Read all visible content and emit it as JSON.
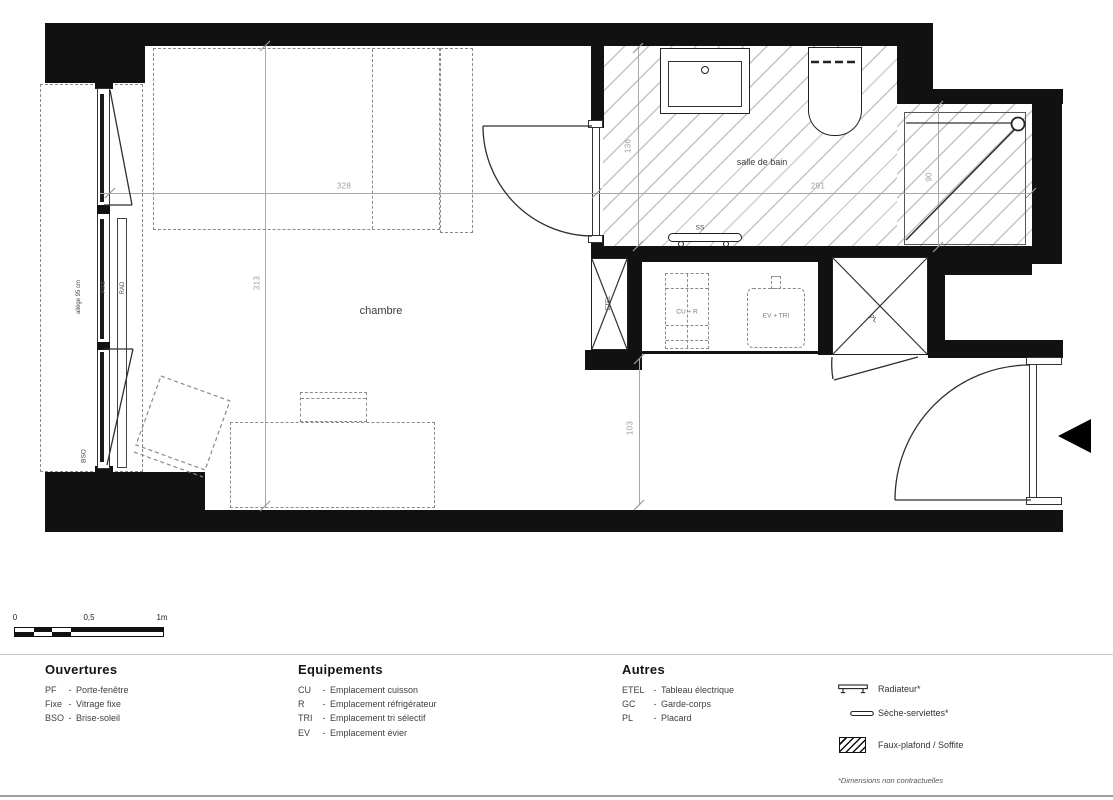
{
  "plan": {
    "rooms": {
      "chambre": "chambre",
      "salle_de_bain": "salle de bain"
    },
    "labels": {
      "ss": "SS",
      "etel": "ETEL",
      "cu_r": "CU + R",
      "ev_tri": "EV + TRI",
      "pl": "PL",
      "fixe": "FIXE",
      "rad": "RAD",
      "bso": "BSO",
      "allege": "allège 95 cm"
    },
    "dims": {
      "chambre_width": "328",
      "chambre_depth": "313",
      "sdb_width": "291",
      "sdb_depth": "136",
      "douche_width": "90",
      "entree_width": "103"
    }
  },
  "scalebar": {
    "tick_0": "0",
    "tick_05": "0,5",
    "tick_1": "1m"
  },
  "legend": {
    "sep": "-",
    "ouvertures": {
      "title": "Ouvertures",
      "items": [
        {
          "abbr": "PF",
          "label": "Porte-fenêtre"
        },
        {
          "abbr": "Fixe",
          "label": "Vitrage fixe"
        },
        {
          "abbr": "BSO",
          "label": "Brise-soleil"
        }
      ]
    },
    "equipements": {
      "title": "Equipements",
      "items": [
        {
          "abbr": "CU",
          "label": "Emplacement cuisson"
        },
        {
          "abbr": "R",
          "label": "Emplacement réfrigérateur"
        },
        {
          "abbr": "TRI",
          "label": "Emplacement tri sélectif"
        },
        {
          "abbr": "EV",
          "label": "Emplacement évier"
        }
      ]
    },
    "autres": {
      "title": "Autres",
      "items": [
        {
          "abbr": "ETEL",
          "label": "Tableau électrique"
        },
        {
          "abbr": "GC",
          "label": "Garde-corps"
        },
        {
          "abbr": "PL",
          "label": "Placard"
        }
      ]
    },
    "symbols": {
      "radiateur": "Radiateur*",
      "seche_serviettes": "Sèche-serviettes*",
      "faux_plafond": "Faux-plafond / Soffite"
    },
    "footnote": "*Dimensions non contractuelles"
  }
}
